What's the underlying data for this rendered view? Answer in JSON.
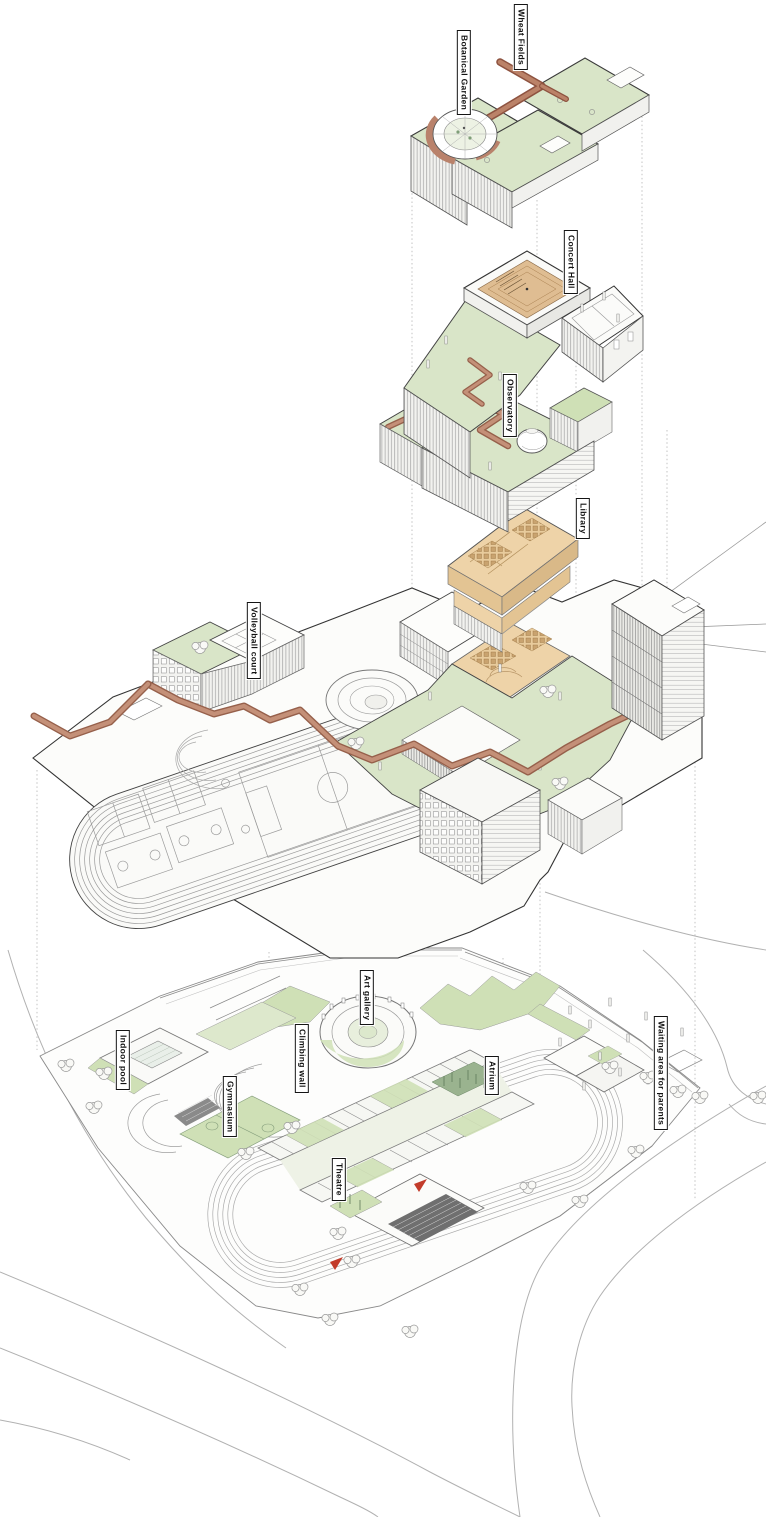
{
  "labels": {
    "wheat_fields": "Wheat Fields",
    "botanical_garden": "Botanical Garden",
    "concert_hall": "Concert Hall",
    "observatory": "Observatory",
    "library": "Library",
    "volleyball_court": "Volleyball court",
    "art_gallery": "Art gallery",
    "climbing_wall": "Climbing wall",
    "indoor_pool": "Indoor pool",
    "gymnasium": "Gymnasium",
    "theatre": "Theatre",
    "atrium": "Atrium",
    "waiting_area": "Waiting area for parents"
  },
  "colors": {
    "roof_green": "#d9e5c8",
    "ground_green": "#cfe0b6",
    "pale_green": "#dde8cc",
    "dense_foliage_green": "#9ab38f",
    "walkway_terracotta": "#b9826b",
    "walkway_edge": "#96604b",
    "wood_floor": "#e6c697",
    "library_tan": "#eed3a8",
    "bleacher_gray": "#787878",
    "outline_dark": "#3a3a3a",
    "line_mid": "#8f8f8f",
    "road_gray": "#b1b1b1",
    "accent_red": "#c23b2a",
    "paper": "#ffffff"
  }
}
